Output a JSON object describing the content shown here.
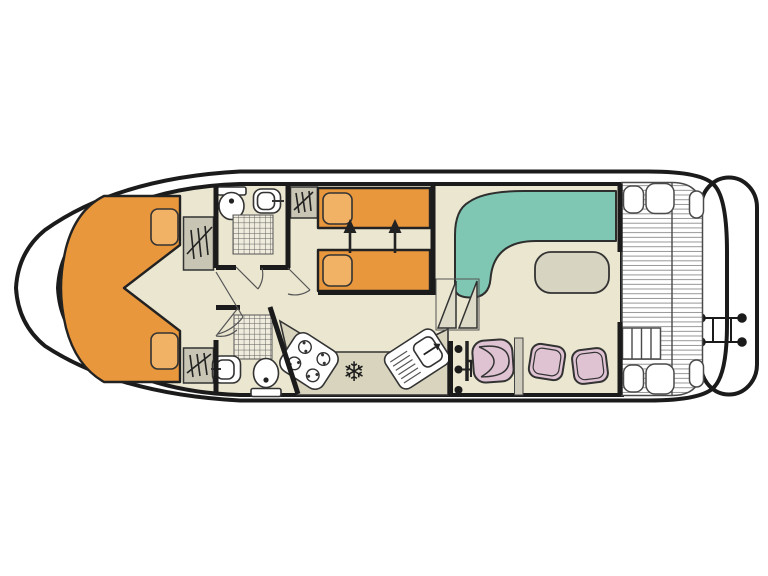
{
  "palette": {
    "ink": "#1b1b1b",
    "floor": "#eae6d0",
    "counter": "#d8d4be",
    "bedOrange": "#e8973d",
    "pillowOrange": "#f2b266",
    "sofaTeal": "#7fc7b2",
    "seatPink": "#dfc3d3",
    "fixtureGray": "#c8c5b4",
    "tableBeige": "#d8d4c2",
    "stepFill": "#dedac8",
    "plankLine": "#8c8c8c"
  },
  "glyphs": {
    "fridge": "❄"
  },
  "diagram": {
    "type": "boat-floorplan",
    "rooms": [
      {
        "name": "bow-cabin",
        "furniture": [
          "v-berth-double-bed",
          "pillow",
          "pillow",
          "wardrobe",
          "wardrobe"
        ]
      },
      {
        "name": "forward-bathroom",
        "furniture": [
          "toilet",
          "washbasin",
          "shower"
        ]
      },
      {
        "name": "twin-cabin",
        "furniture": [
          "single-bed",
          "single-bed",
          "wardrobe",
          "slide-together-arrows"
        ]
      },
      {
        "name": "aft-bathroom",
        "furniture": [
          "shower",
          "washbasin",
          "toilet"
        ]
      },
      {
        "name": "galley",
        "furniture": [
          "stove-four-burners",
          "fridge",
          "sink-with-drainer",
          "helm-console"
        ]
      },
      {
        "name": "saloon",
        "furniture": [
          "l-shaped-sofa",
          "table",
          "helm-seat",
          "stool",
          "stool",
          "steps"
        ]
      },
      {
        "name": "aft-deck",
        "furniture": [
          "planking",
          "bench-seats",
          "deck-steps"
        ]
      },
      {
        "name": "stern",
        "furniture": [
          "swim-platform",
          "swim-ladder"
        ]
      }
    ]
  }
}
